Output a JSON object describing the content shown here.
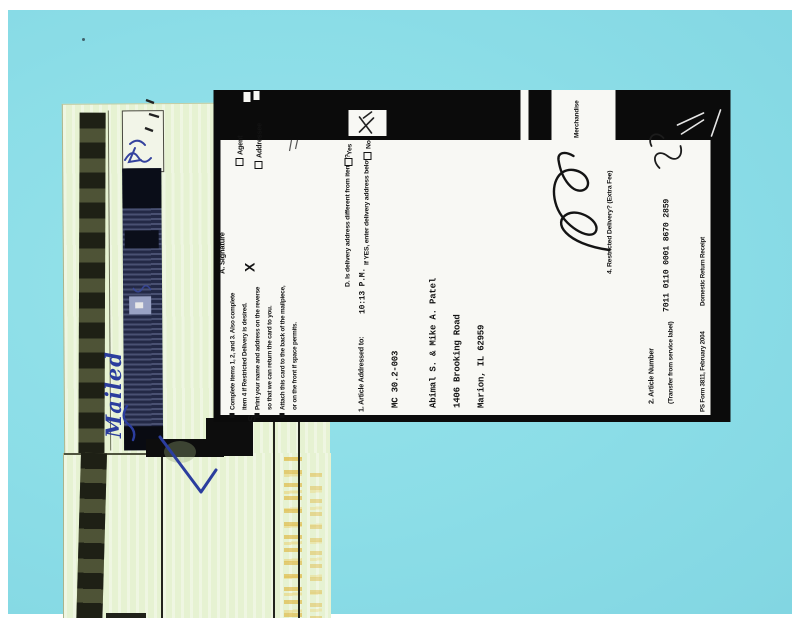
{
  "photo": {
    "background_color": "#8bdde7"
  },
  "envelope": {
    "handwriting_word": "Mailed"
  },
  "receipt_card": {
    "delivery_section": {
      "signature_label": "A. Signature",
      "signature_x": "X",
      "agent_label": "Agent",
      "addressee_label": "Addressee",
      "delivery_question": "D. Is delivery address different from item 1?",
      "yes_label": "Yes",
      "enter_below": "If YES, enter delivery address below:",
      "no_label": "No"
    },
    "sender_instructions": {
      "initial": "S",
      "lines": [
        "Complete items 1, 2, and 3. Also complete",
        "item 4 if Restricted Delivery is desired.",
        "Print your name and address on the reverse",
        "so that we can return the card to you.",
        "Attach this card to the back of the mailpiece,",
        "or on the front if space permits."
      ]
    },
    "addressee_block": {
      "label": "1. Article Addressed to:",
      "time_stamp": "10:13 P.M.",
      "lines": [
        "MC 30.2-003",
        "Abimal S. & Mike A. Patel",
        "1406 Brooking Road",
        "Marion, IL 62959"
      ]
    },
    "service_section": {
      "merchandise_label": "Merchandise",
      "restricted_label": "4. Restricted Delivery? (Extra Fee)"
    },
    "article_section": {
      "number_label": "2. Article Number",
      "transfer_label": "(Transfer from service label)",
      "article_number": "7011 0110 0001 8670 2859"
    },
    "footer": {
      "form_id": "PS Form 3811, February 2004",
      "form_title": "Domestic Return Receipt"
    }
  },
  "colors": {
    "photo_cyan": "#8bdde7",
    "sheet_green": "#e6f2d2",
    "band_navy": "#232946",
    "strip_olive": "#42462f",
    "ink_blue": "#2b3d9e",
    "scan_black": "#0b0b0b"
  }
}
